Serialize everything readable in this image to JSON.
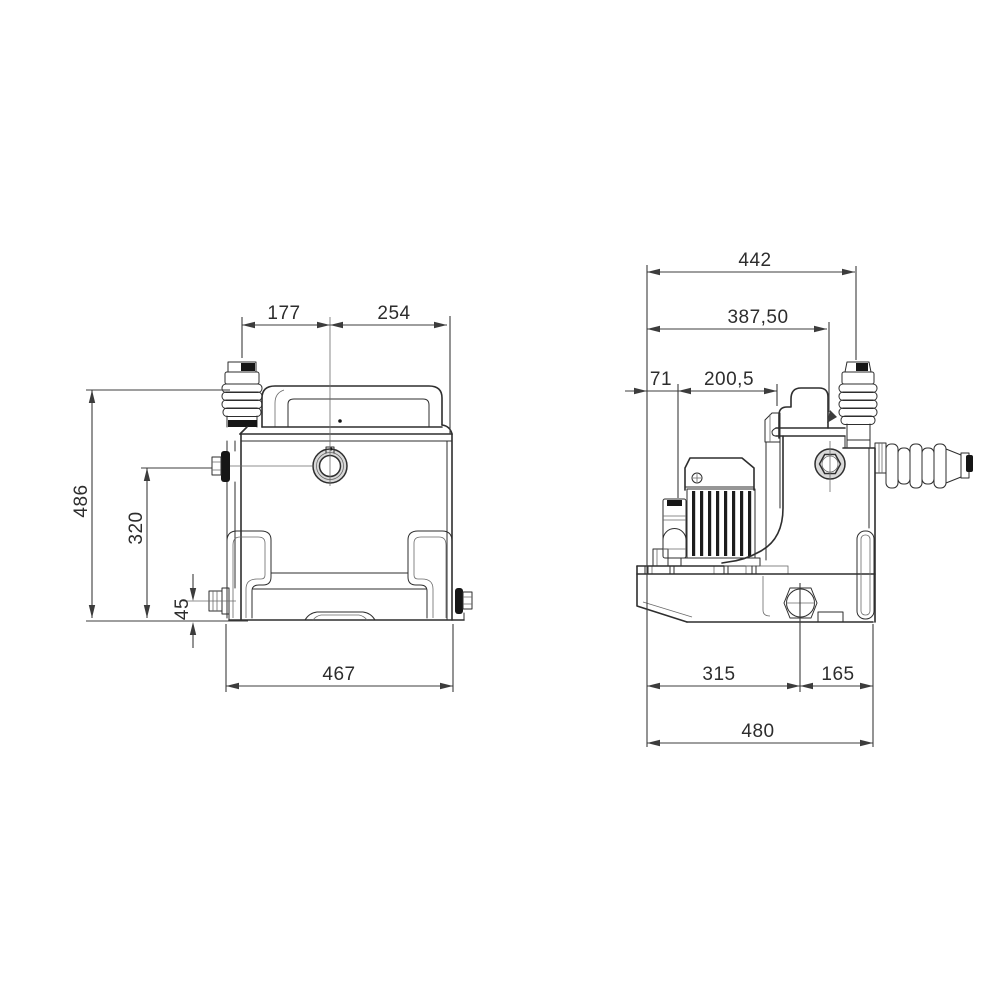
{
  "drawing": {
    "type": "technical-dimension-drawing",
    "subject": "macerator-lifting-pump",
    "background": "#ffffff",
    "line_color": "#2e2e2e",
    "dim_color": "#3c3c3c",
    "views": {
      "front": {
        "name": "front-view",
        "dimensions": {
          "vent_offset": "177",
          "vent_to_edge": "254",
          "overall_height": "486",
          "inlet_height": "320",
          "outlet_height": "45",
          "base_width": "467"
        }
      },
      "side": {
        "name": "side-view",
        "dimensions": {
          "overall_to_vent": "442",
          "to_discharge": "387,50",
          "to_capacitor": "71",
          "capacitor_to_lid": "200,5",
          "to_drain": "315",
          "drain_to_back": "165",
          "overall_depth": "480"
        }
      }
    }
  }
}
